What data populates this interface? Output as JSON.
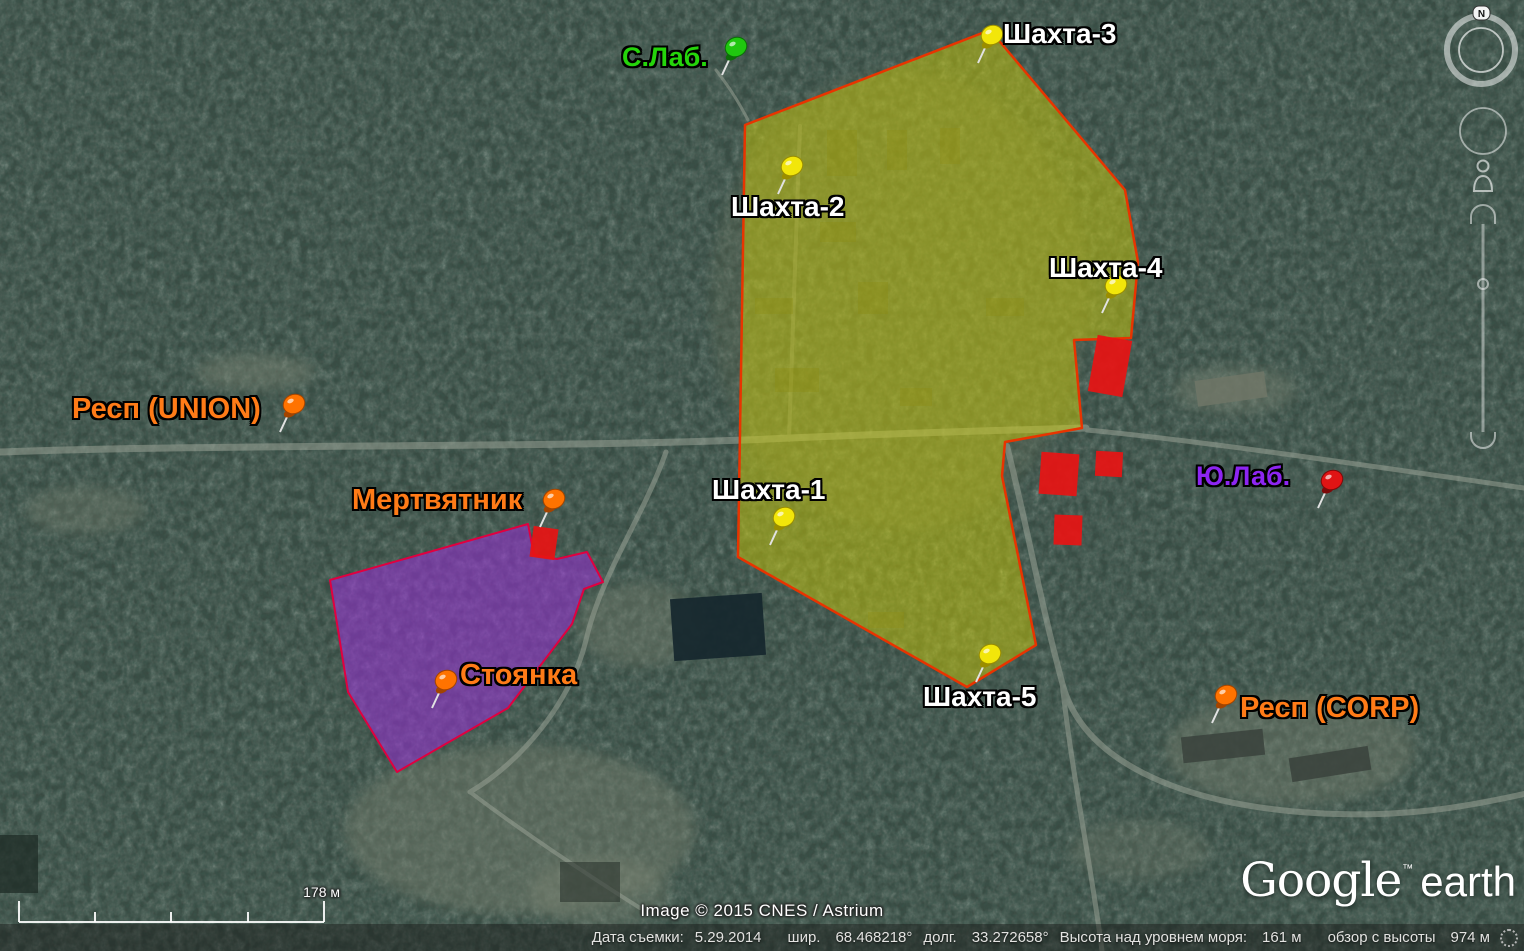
{
  "ui": {
    "north_indicator": "N",
    "copyright": "Image © 2015 CNES / Astrium",
    "logo": {
      "google": "Google",
      "tm": "™",
      "earth": "earth"
    },
    "scalebar": {
      "label": "178 м"
    },
    "statusbar": {
      "capture_date_label": "Дата съемки:",
      "capture_date": "5.29.2014",
      "lat_label": "шир.",
      "lat": "68.468218°",
      "lon_label": "долг.",
      "lon": "33.272658°",
      "elevation_label": "Высота над уровнем моря:",
      "elevation": "161 м",
      "eye_alt_label": "обзор с высоты",
      "eye_alt": "974 м"
    }
  },
  "map": {
    "building_color": "#e81414",
    "zones": [
      {
        "name": "zone-mines",
        "fill": "#d8d400",
        "fill_opacity": 0.45,
        "stroke": "#e83400",
        "stroke_width": 2.5,
        "points": [
          [
            990,
            30
          ],
          [
            1125,
            190
          ],
          [
            1138,
            262
          ],
          [
            1131,
            338
          ],
          [
            1074,
            340
          ],
          [
            1082,
            428
          ],
          [
            1005,
            442
          ],
          [
            1002,
            476
          ],
          [
            1036,
            645
          ],
          [
            967,
            687
          ],
          [
            738,
            557
          ],
          [
            745,
            125
          ]
        ]
      },
      {
        "name": "zone-parking",
        "fill": "#9a30d8",
        "fill_opacity": 0.55,
        "stroke": "#e00040",
        "stroke_width": 2,
        "points": [
          [
            330,
            580
          ],
          [
            528,
            524
          ],
          [
            534,
            555
          ],
          [
            557,
            559
          ],
          [
            587,
            552
          ],
          [
            603,
            582
          ],
          [
            584,
            589
          ],
          [
            572,
            624
          ],
          [
            508,
            708
          ],
          [
            397,
            772
          ],
          [
            348,
            692
          ]
        ]
      }
    ],
    "buildings": [
      {
        "cx": 1110,
        "cy": 366,
        "w": 35,
        "h": 57,
        "rot": 10
      },
      {
        "cx": 1059,
        "cy": 474,
        "w": 38,
        "h": 42,
        "rot": 4
      },
      {
        "cx": 1109,
        "cy": 464,
        "w": 27,
        "h": 25,
        "rot": 3
      },
      {
        "cx": 1068,
        "cy": 530,
        "w": 28,
        "h": 30,
        "rot": 2
      },
      {
        "cx": 544,
        "cy": 543,
        "w": 25,
        "h": 31,
        "rot": 8
      }
    ],
    "placemarks": [
      {
        "id": "shahta-3",
        "label": "Шахта-3",
        "text_color": "#ffffff",
        "font_size": 28,
        "label_x": 1003,
        "label_y": 20,
        "pin": {
          "color": "#f2e60a",
          "dark": "#9a8d00",
          "x": 978,
          "y": 63
        }
      },
      {
        "id": "shahta-2",
        "label": "Шахта-2",
        "text_color": "#ffffff",
        "font_size": 28,
        "label_x": 731,
        "label_y": 193,
        "pin": {
          "color": "#f2e60a",
          "dark": "#9a8d00",
          "x": 778,
          "y": 194
        }
      },
      {
        "id": "shahta-4",
        "label": "Шахта-4",
        "text_color": "#ffffff",
        "font_size": 28,
        "label_x": 1049,
        "label_y": 254,
        "pin": {
          "color": "#f2e60a",
          "dark": "#9a8d00",
          "x": 1102,
          "y": 313
        }
      },
      {
        "id": "shahta-1",
        "label": "Шахта-1",
        "text_color": "#ffffff",
        "font_size": 28,
        "label_x": 712,
        "label_y": 476,
        "pin": {
          "color": "#f2e60a",
          "dark": "#9a8d00",
          "x": 770,
          "y": 545
        }
      },
      {
        "id": "shahta-5",
        "label": "Шахта-5",
        "text_color": "#ffffff",
        "font_size": 28,
        "label_x": 923,
        "label_y": 683,
        "pin": {
          "color": "#f2e60a",
          "dark": "#9a8d00",
          "x": 976,
          "y": 682
        }
      },
      {
        "id": "s-lab",
        "label": "С.Лаб.",
        "text_color": "#25d40b",
        "font_size": 27,
        "label_x": 622,
        "label_y": 44,
        "pin": {
          "color": "#1fc70f",
          "dark": "#0c6e08",
          "x": 722,
          "y": 75
        }
      },
      {
        "id": "yu-lab",
        "label": "Ю.Лаб.",
        "text_color": "#8d25f2",
        "font_size": 27,
        "label_x": 1196,
        "label_y": 463,
        "pin": {
          "color": "#e01414",
          "dark": "#7d0a0a",
          "x": 1318,
          "y": 508
        }
      },
      {
        "id": "resp-union",
        "label": "Респ (UNION)",
        "text_color": "#ff7b17",
        "font_size": 29,
        "label_x": 72,
        "label_y": 395,
        "pin": {
          "color": "#ff7300",
          "dark": "#a34400",
          "x": 280,
          "y": 432
        }
      },
      {
        "id": "mertvyatnik",
        "label": "Мертвятник",
        "text_color": "#ff7b17",
        "font_size": 29,
        "label_x": 352,
        "label_y": 486,
        "pin": {
          "color": "#ff7300",
          "dark": "#a34400",
          "x": 540,
          "y": 527
        }
      },
      {
        "id": "stoyanka",
        "label": "Стоянка",
        "text_color": "#ff7b17",
        "font_size": 29,
        "label_x": 460,
        "label_y": 661,
        "pin": {
          "color": "#ff7300",
          "dark": "#a34400",
          "x": 432,
          "y": 708
        }
      },
      {
        "id": "resp-corp",
        "label": "Респ (CORP)",
        "text_color": "#ff7b17",
        "font_size": 29,
        "label_x": 1240,
        "label_y": 694,
        "pin": {
          "color": "#ff7300",
          "dark": "#a34400",
          "x": 1212,
          "y": 723
        }
      }
    ]
  }
}
